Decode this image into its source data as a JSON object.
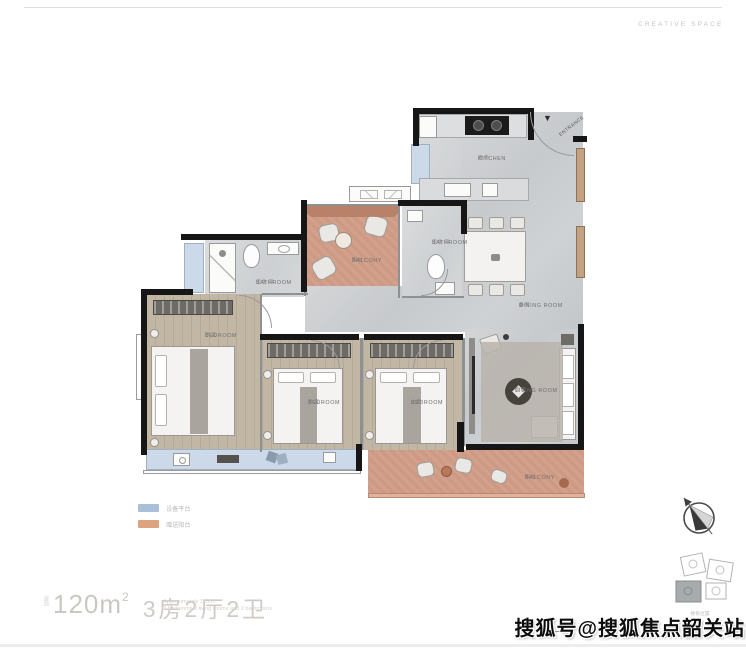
{
  "header": {
    "brand": "CREATIVE SPACE"
  },
  "plan": {
    "rooms": {
      "kitchen": {
        "label": "KITCHEN",
        "sub": "厨房"
      },
      "dining": {
        "label": "DINING ROOM",
        "sub": "餐厅"
      },
      "living": {
        "label": "LIVING ROOM",
        "sub": "客厅"
      },
      "balcony_top": {
        "label": "BALCONY",
        "sub": "阳台"
      },
      "balcony_bottom": {
        "label": "BALCONY",
        "sub": "阳台"
      },
      "bathroom_mid": {
        "label": "BATHROOM",
        "sub": "卫生间"
      },
      "bathroom_left": {
        "label": "BATHROOM",
        "sub": "卫生间"
      },
      "bedroom_left": {
        "label": "BEDROOM",
        "sub": "卧室"
      },
      "bedroom_mid": {
        "label": "BEDROOM",
        "sub": "卧室"
      },
      "bedroom_master": {
        "label": "BEDROOM",
        "sub": "主卧"
      },
      "entrance": {
        "label": "ENTRANCE",
        "sub": "入户"
      }
    },
    "entrance_arrow": "▼"
  },
  "legend": {
    "items": [
      {
        "label": "设备平台",
        "color": "#aabfd8"
      },
      {
        "label": "赠送阳台",
        "color": "#dba47f"
      }
    ]
  },
  "stat": {
    "prefix": "建面",
    "area": "120m",
    "area_sup": "2",
    "layout": "3房2厅2卫",
    "en_line1": "Approximately 120m²",
    "en_line2": "3 bedrooms 2 living rooms and 2 bathrooms"
  },
  "keyplan": {
    "note": "楼栋位置"
  },
  "watermark": {
    "text": "搜狐号@搜狐焦点韶关站"
  },
  "colors": {
    "wall": "#161616",
    "tile": "#cdd0d2",
    "wood": "#c2b6a5",
    "balcony_terracotta": "#cf9a84",
    "equipment_blue": "#cbd9e8"
  }
}
